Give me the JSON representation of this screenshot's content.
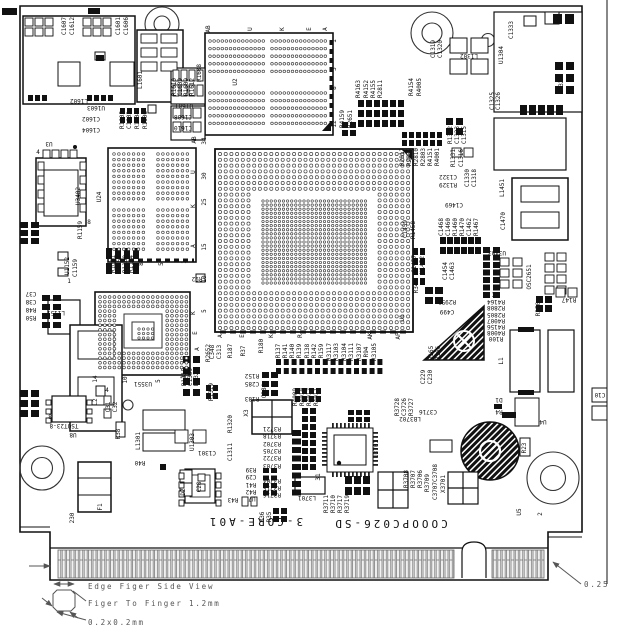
{
  "board": {
    "part_number": "COOOPC026-SD",
    "revision": "3-CORE-A01",
    "type_note": "PCB assembly silkscreen drawing, top side"
  },
  "annotations": {
    "edge_view": "Edge Figer Side View",
    "finger_pitch": "Figer To Finger 1.2mm",
    "finger_size": "0.2x0.2mm",
    "corner_dim": "0.25"
  },
  "labels": [
    [
      "C1607",
      66,
      26,
      90
    ],
    [
      "C1612",
      74,
      26,
      90
    ],
    [
      "C1601",
      120,
      26,
      90
    ],
    [
      "C1606",
      128,
      26,
      90
    ],
    [
      "L1602",
      79,
      103,
      180
    ],
    [
      "L1601",
      142,
      80,
      90
    ],
    [
      "U1603",
      96,
      110,
      180
    ],
    [
      "C1602",
      91,
      121,
      180
    ],
    [
      "C1604",
      91,
      132,
      180
    ],
    [
      "R1605",
      124,
      120,
      90
    ],
    [
      "C1603",
      131,
      120,
      90
    ],
    [
      "R1604",
      139,
      120,
      90
    ],
    [
      "R1606",
      147,
      120,
      90
    ],
    [
      "R1610",
      176,
      87,
      90
    ],
    [
      "C1609",
      182,
      87,
      90
    ],
    [
      "R1609",
      188,
      87,
      90
    ],
    [
      "R1612",
      194,
      87,
      90
    ],
    [
      "R1608",
      201,
      73,
      90
    ],
    [
      "U1601",
      184,
      108,
      180
    ],
    [
      "C1608",
      183,
      119,
      180
    ],
    [
      "C1610",
      183,
      130,
      180
    ],
    [
      "U3",
      49,
      146,
      180
    ],
    [
      "4",
      38,
      154,
      0
    ],
    [
      "U3402",
      80,
      196,
      90
    ],
    [
      "8",
      89,
      224,
      0
    ],
    [
      "R1159",
      82,
      230,
      90
    ],
    [
      "U1152",
      69,
      266,
      90
    ],
    [
      "C1159",
      77,
      268,
      90
    ],
    [
      "1",
      69,
      283,
      0
    ],
    [
      "R1161",
      115,
      264,
      90
    ],
    [
      "C1157",
      121,
      264,
      90
    ],
    [
      "R1160",
      127,
      264,
      90
    ],
    [
      "R1164",
      133,
      264,
      90
    ],
    [
      "C37",
      31,
      296,
      180
    ],
    [
      "C38",
      31,
      304,
      180
    ],
    [
      "R48",
      31,
      312,
      180
    ],
    [
      "R50",
      31,
      320,
      180
    ],
    [
      "L1151",
      56,
      315,
      180
    ],
    [
      "R92",
      197,
      281,
      180
    ],
    [
      "AB",
      210,
      29,
      90
    ],
    [
      "U",
      252,
      29,
      90
    ],
    [
      "K",
      284,
      29,
      90
    ],
    [
      "E",
      311,
      29,
      90
    ],
    [
      "A",
      327,
      29,
      90
    ],
    [
      "1",
      336,
      41,
      90
    ],
    [
      "5",
      336,
      69,
      90
    ],
    [
      "8",
      336,
      88,
      90
    ],
    [
      "12",
      336,
      124,
      90
    ],
    [
      "U2",
      237,
      82,
      90
    ],
    [
      "AB",
      196,
      140,
      90
    ],
    [
      "34",
      206,
      141,
      90
    ],
    [
      "U",
      195,
      172,
      90
    ],
    [
      "30",
      206,
      176,
      90
    ],
    [
      "K",
      195,
      206,
      90
    ],
    [
      "25",
      206,
      202,
      90
    ],
    [
      "A",
      195,
      246,
      90
    ],
    [
      "15",
      206,
      247,
      90
    ],
    [
      "10",
      206,
      279,
      90
    ],
    [
      "5",
      206,
      311,
      90
    ],
    [
      "U1",
      404,
      318,
      90
    ],
    [
      "A",
      222,
      336,
      90
    ],
    [
      "E",
      244,
      336,
      90
    ],
    [
      "K",
      273,
      336,
      90
    ],
    [
      "R",
      302,
      336,
      90
    ],
    [
      "AK",
      372,
      336,
      90
    ],
    [
      "AP",
      400,
      336,
      90
    ],
    [
      "U24",
      101,
      197,
      90
    ],
    [
      "12",
      116,
      264,
      90
    ],
    [
      "8",
      143,
      264,
      90
    ],
    [
      "5",
      163,
      264,
      90
    ],
    [
      "1",
      186,
      262,
      90
    ],
    [
      "R4163",
      360,
      89,
      90
    ],
    [
      "R4152",
      368,
      89,
      90
    ],
    [
      "R4155",
      375,
      89,
      90
    ],
    [
      "R2811",
      382,
      89,
      90
    ],
    [
      "R4154",
      413,
      87,
      90
    ],
    [
      "R4005",
      421,
      87,
      90
    ],
    [
      "R4159",
      344,
      119,
      90
    ],
    [
      "R2651",
      352,
      119,
      90
    ],
    [
      "R2812",
      404,
      157,
      90
    ],
    [
      "R2809",
      411,
      157,
      90
    ],
    [
      "R2810",
      418,
      157,
      90
    ],
    [
      "R2803",
      425,
      157,
      90
    ],
    [
      "R4151",
      432,
      157,
      90
    ],
    [
      "R4001",
      439,
      157,
      90
    ],
    [
      "C1319",
      435,
      49,
      90
    ],
    [
      "C1320",
      442,
      49,
      90
    ],
    [
      "L1302",
      469,
      58,
      180
    ],
    [
      "U1304",
      503,
      55,
      90
    ],
    [
      "C1333",
      513,
      30,
      90
    ],
    [
      "R1328",
      563,
      85,
      90
    ],
    [
      "C1325",
      494,
      101,
      90
    ],
    [
      "C1326",
      500,
      101,
      90
    ],
    [
      "R1332",
      452,
      135,
      90
    ],
    [
      "C1323",
      459,
      135,
      90
    ],
    [
      "C1315",
      466,
      135,
      90
    ],
    [
      "R1331",
      455,
      158,
      90
    ],
    [
      "C1316",
      463,
      158,
      90
    ],
    [
      "C1322",
      448,
      179,
      180
    ],
    [
      "R1329",
      448,
      187,
      180
    ],
    [
      "C1330",
      469,
      178,
      90
    ],
    [
      "C1318",
      476,
      178,
      90
    ],
    [
      "L1451",
      504,
      188,
      90
    ],
    [
      "C1470",
      505,
      221,
      90
    ],
    [
      "C1469",
      454,
      207,
      180
    ],
    [
      "C1468",
      443,
      227,
      90
    ],
    [
      "C1460",
      450,
      227,
      90
    ],
    [
      "R1460",
      457,
      227,
      90
    ],
    [
      "R1470",
      464,
      227,
      90
    ],
    [
      "C1462",
      471,
      227,
      90
    ],
    [
      "R1467",
      478,
      227,
      90
    ],
    [
      "C1459",
      407,
      229,
      90
    ],
    [
      "R1458",
      415,
      230,
      90
    ],
    [
      "C1457",
      416,
      264,
      90
    ],
    [
      "U1452",
      424,
      265,
      90
    ],
    [
      "C1454",
      447,
      271,
      90
    ],
    [
      "C1463",
      454,
      271,
      90
    ],
    [
      "R34",
      418,
      288,
      90
    ],
    [
      "R2953",
      447,
      304,
      180
    ],
    [
      "C499",
      447,
      314,
      180
    ],
    [
      "R4164",
      496,
      304,
      180
    ],
    [
      "R2808",
      496,
      310,
      180
    ],
    [
      "R2805",
      496,
      317,
      180
    ],
    [
      "R4007",
      496,
      323,
      180
    ],
    [
      "R4156",
      496,
      329,
      180
    ],
    [
      "R4008",
      496,
      335,
      180
    ],
    [
      "R100",
      496,
      341,
      180
    ],
    [
      "R165",
      433,
      353,
      90
    ],
    [
      "R166",
      440,
      353,
      90
    ],
    [
      "C229",
      425,
      377,
      90
    ],
    [
      "C230",
      432,
      377,
      90
    ],
    [
      "L1",
      503,
      361,
      90
    ],
    [
      "U3403",
      497,
      255,
      180
    ],
    [
      "1",
      493,
      297,
      0
    ],
    [
      "OSC2651",
      531,
      277,
      90
    ],
    [
      "R350",
      540,
      309,
      90
    ],
    [
      "R147",
      569,
      302,
      180
    ],
    [
      "U3551",
      143,
      386,
      180
    ],
    [
      "14",
      97,
      379,
      90
    ],
    [
      "10",
      127,
      380,
      90
    ],
    [
      "5",
      160,
      381,
      90
    ],
    [
      "1",
      185,
      377,
      90
    ],
    [
      "K",
      195,
      313,
      90
    ],
    [
      "E",
      197,
      333,
      90
    ],
    [
      "A",
      199,
      349,
      90
    ],
    [
      "TSOT23-8",
      64,
      428,
      180
    ],
    [
      "U8",
      73,
      437,
      180
    ],
    [
      "L2",
      97,
      402,
      90
    ],
    [
      "4",
      107,
      392,
      0
    ],
    [
      "8",
      50,
      419,
      0
    ],
    [
      "C31",
      110,
      407,
      90
    ],
    [
      "C32",
      117,
      407,
      90
    ],
    [
      "R38",
      120,
      434,
      90
    ],
    [
      "L1301",
      140,
      441,
      90
    ],
    [
      "R40",
      140,
      465,
      180
    ],
    [
      "U1303",
      194,
      442,
      90
    ],
    [
      "C1301",
      207,
      455,
      180
    ],
    [
      "R1320",
      232,
      424,
      90
    ],
    [
      "C1311",
      232,
      452,
      90
    ],
    [
      "R36",
      264,
      517,
      90
    ],
    [
      "R35",
      271,
      517,
      90
    ],
    [
      "R43",
      233,
      502,
      180
    ],
    [
      "C28",
      201,
      487,
      90
    ],
    [
      "U7",
      252,
      501,
      180
    ],
    [
      "D2",
      185,
      492,
      90
    ],
    [
      "F1",
      102,
      507,
      90
    ],
    [
      "230",
      74,
      518,
      90
    ],
    [
      "R2652",
      210,
      353,
      90
    ],
    [
      "R1315",
      186,
      377,
      90
    ],
    [
      "C1309",
      192,
      377,
      90
    ],
    [
      "R1325",
      198,
      377,
      90
    ],
    [
      "R1319",
      213,
      392,
      90
    ],
    [
      "C348",
      214,
      352,
      90
    ],
    [
      "C313",
      221,
      352,
      90
    ],
    [
      "R187",
      232,
      351,
      90
    ],
    [
      "R37",
      245,
      351,
      90
    ],
    [
      "R180",
      263,
      346,
      90
    ],
    [
      "R137",
      280,
      351,
      90
    ],
    [
      "R141",
      287,
      351,
      90
    ],
    [
      "R140",
      294,
      351,
      90
    ],
    [
      "R139",
      301,
      351,
      90
    ],
    [
      "R138",
      309,
      351,
      90
    ],
    [
      "R142",
      316,
      351,
      90
    ],
    [
      "R159",
      323,
      351,
      90
    ],
    [
      "R3117",
      331,
      352,
      90
    ],
    [
      "R3103",
      338,
      352,
      90
    ],
    [
      "R3104",
      346,
      352,
      90
    ],
    [
      "R3111",
      353,
      352,
      90
    ],
    [
      "R3107",
      361,
      352,
      90
    ],
    [
      "R94",
      368,
      352,
      90
    ],
    [
      "R3105",
      376,
      352,
      90
    ],
    [
      "R4009",
      297,
      397,
      90
    ],
    [
      "R4010",
      304,
      397,
      90
    ],
    [
      "R4012",
      311,
      397,
      90
    ],
    [
      "R4011",
      318,
      397,
      90
    ],
    [
      "R152",
      252,
      378,
      180
    ],
    [
      "C285",
      252,
      386,
      180
    ],
    [
      "R183",
      252,
      401,
      180
    ],
    [
      "C284",
      266,
      391,
      90
    ],
    [
      "X3",
      248,
      413,
      90
    ],
    [
      "R3721",
      272,
      431,
      180
    ],
    [
      "R3718",
      272,
      438,
      180
    ],
    [
      "R3702",
      272,
      446,
      180
    ],
    [
      "R3705",
      272,
      453,
      180
    ],
    [
      "R3722",
      272,
      460,
      180
    ],
    [
      "R3703",
      272,
      468,
      180
    ],
    [
      "R39",
      251,
      472,
      180
    ],
    [
      "C29",
      251,
      479,
      180
    ],
    [
      "R41",
      251,
      487,
      180
    ],
    [
      "R42",
      251,
      494,
      180
    ],
    [
      "R3704",
      272,
      483,
      180
    ],
    [
      "R3715",
      272,
      490,
      180
    ],
    [
      "R3716",
      272,
      497,
      180
    ],
    [
      "31",
      320,
      477,
      90
    ],
    [
      "L3701",
      307,
      500,
      180
    ],
    [
      "U3701",
      378,
      449,
      90
    ],
    [
      "R3728",
      399,
      407,
      90
    ],
    [
      "C3726",
      406,
      407,
      90
    ],
    [
      "R3727",
      413,
      407,
      90
    ],
    [
      "C3716",
      428,
      414,
      180
    ],
    [
      "LB3702",
      410,
      421,
      180
    ],
    [
      "R3711",
      328,
      504,
      90
    ],
    [
      "R3710",
      335,
      504,
      90
    ],
    [
      "R3717",
      342,
      504,
      90
    ],
    [
      "R3719",
      349,
      504,
      90
    ],
    [
      "R3708",
      408,
      479,
      90
    ],
    [
      "R3707",
      415,
      479,
      90
    ],
    [
      "R3706",
      422,
      479,
      90
    ],
    [
      "R3709",
      429,
      483,
      90
    ],
    [
      "C3708",
      437,
      473,
      90
    ],
    [
      "C3707",
      437,
      491,
      90
    ],
    [
      "X3701",
      445,
      484,
      90
    ],
    [
      "U5",
      521,
      512,
      90
    ],
    [
      "2",
      542,
      514,
      90
    ],
    [
      "D1",
      499,
      402,
      180
    ],
    [
      "R4",
      499,
      414,
      180
    ],
    [
      "U4",
      543,
      424,
      180
    ],
    [
      "C10",
      600,
      397,
      180
    ],
    [
      "R23",
      526,
      448,
      90
    ]
  ]
}
